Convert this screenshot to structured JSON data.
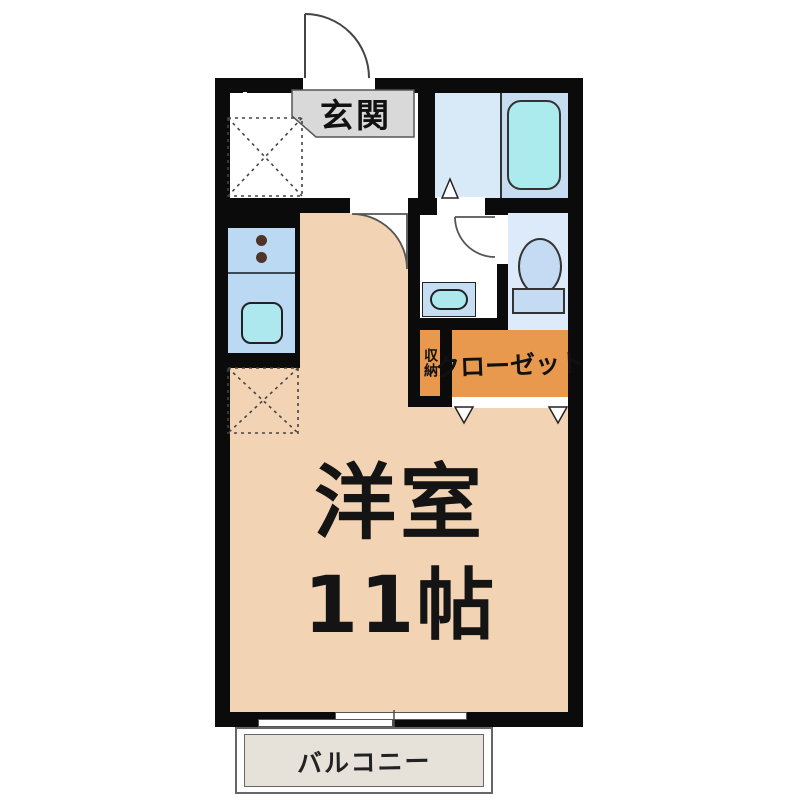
{
  "floorplan": {
    "rooms": {
      "genkan": {
        "label": "玄関"
      },
      "main_room": {
        "label": "洋室",
        "size": "11帖"
      },
      "storage": {
        "label": "収納"
      },
      "closet": {
        "label": "クローゼット"
      },
      "balcony": {
        "label": "バルコニー"
      }
    },
    "fixtures": [
      "bathtub",
      "bathroom-floor",
      "toilet",
      "washbasin",
      "washbasin-counter",
      "kitchen-sink",
      "stove-burners",
      "refrigerator-space-dashed-box",
      "washing-machine-space-dashed-box",
      "entrance-swing-door",
      "main-room-swing-door",
      "washroom-swing-door",
      "bath-folding-door-marker",
      "closet-folding-door-markers",
      "sliding-window",
      "balcony-deck"
    ],
    "colors": {
      "wall": "#0b0b0b",
      "main_room_floor": "#f2d4b4",
      "closet_orange": "#e9994e",
      "kitchen_blue": "#bbd9f2",
      "bath_floor": "#d8eaf8",
      "tub_panel": "#c6ddf1",
      "bathtub_cyan": "#abebee",
      "toilet_floor": "#dceaf9",
      "fixture_blue": "#c5daf3",
      "sink_cyan": "#aee8ef",
      "genkan_gray": "#d9d9d9",
      "balcony_fill": "#e6e1d9"
    }
  }
}
